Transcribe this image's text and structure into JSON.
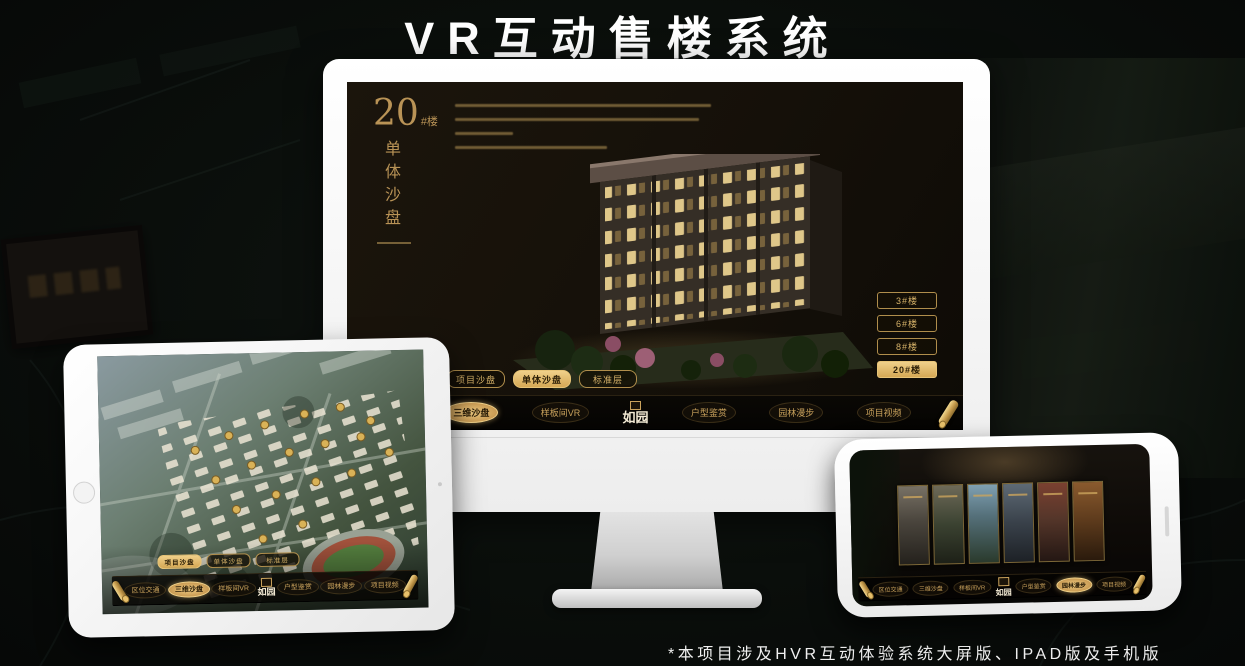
{
  "poster": {
    "title": "VR互动售楼系统",
    "footnote": "*本项目涉及HVR互动体验系统大屏版、IPAD版及手机版"
  },
  "brand": {
    "logo": "如园"
  },
  "colors": {
    "gold": "#c9a25c",
    "gold_selected": "#e8c57c",
    "screen_bg": "#17130c"
  },
  "monitor_ui": {
    "headline": {
      "number": "20",
      "unit": "#楼",
      "subtitle": "单体沙盘"
    },
    "floor_buttons": [
      {
        "label": "3#楼",
        "selected": false
      },
      {
        "label": "6#楼",
        "selected": false
      },
      {
        "label": "8#楼",
        "selected": false
      },
      {
        "label": "20#楼",
        "selected": true
      }
    ],
    "view_tabs": [
      {
        "label": "项目沙盘",
        "selected": false
      },
      {
        "label": "单体沙盘",
        "selected": true
      },
      {
        "label": "标准层",
        "selected": false
      }
    ],
    "nav_items": [
      {
        "label": "区位交通",
        "selected": false
      },
      {
        "label": "三维沙盘",
        "selected": true
      },
      {
        "label": "样板间VR",
        "selected": false
      },
      {
        "label": "户型鉴赏",
        "selected": false
      },
      {
        "label": "园林漫步",
        "selected": false
      },
      {
        "label": "项目视频",
        "selected": false
      }
    ]
  },
  "ipad_ui": {
    "view_tabs": [
      {
        "label": "项目沙盘",
        "selected": true
      },
      {
        "label": "单体沙盘",
        "selected": false
      },
      {
        "label": "标准层",
        "selected": false
      }
    ],
    "nav_items": [
      {
        "label": "区位交通",
        "selected": false
      },
      {
        "label": "三维沙盘",
        "selected": true
      },
      {
        "label": "样板间VR",
        "selected": false
      },
      {
        "label": "户型鉴赏",
        "selected": false
      },
      {
        "label": "园林漫步",
        "selected": false
      },
      {
        "label": "项目视频",
        "selected": false
      }
    ]
  },
  "phone_ui": {
    "nav_items": [
      {
        "label": "区位交通",
        "selected": false
      },
      {
        "label": "三维沙盘",
        "selected": false
      },
      {
        "label": "样板间VR",
        "selected": false
      },
      {
        "label": "户型鉴赏",
        "selected": false
      },
      {
        "label": "园林漫步",
        "selected": true
      },
      {
        "label": "项目视频",
        "selected": false
      }
    ]
  }
}
